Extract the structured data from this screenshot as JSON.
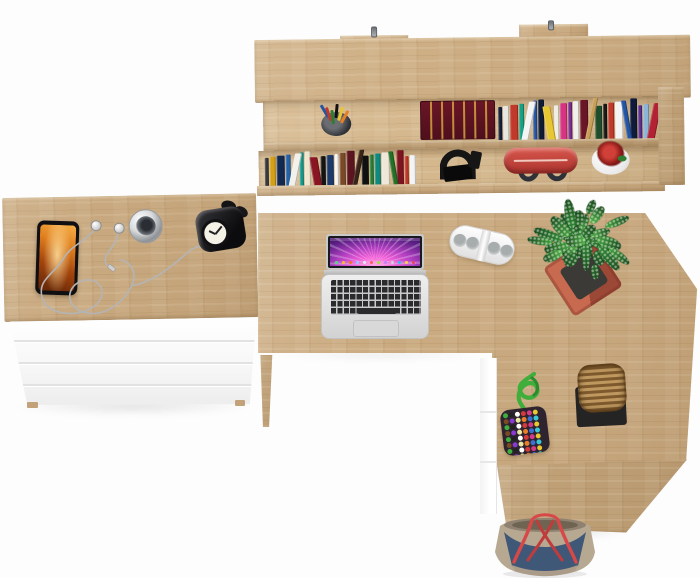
{
  "scene": {
    "description": "Top-down product photo of an oak office set: wall shelf full of books, chest of drawers with white fronts, and an L-shaped oak desk with a laptop and accessories",
    "background": "#fdfdfd"
  },
  "palette": {
    "oak": "#cbab81",
    "oak_light": "#d6b98f",
    "oak_dark": "#bfa076",
    "panel_white": "#fbfbfb",
    "pot_terracotta": "#b85a42",
    "plant_green": "#3c9a3f",
    "shelf_bag_red": "#c84540",
    "tote_denim": "#3f5878",
    "tote_canvas": "#b7a892",
    "strap_red": "#d84848",
    "rope_green": "#3fae3b",
    "red_book": "#5c1322"
  },
  "items": [
    "wall shelf with books",
    "mounting hooks",
    "pen cup",
    "red hardcover book",
    "black headphones",
    "red duffel bag",
    "white flower pot with red flowers",
    "chest of drawers",
    "smartphone",
    "white earphones",
    "chrome pocket watch",
    "black alarm clock",
    "l-shaped oak desk",
    "open laptop",
    "white power strip",
    "succulent in terracotta pot",
    "beaded pouch with green rope",
    "wicker basket on black tray",
    "canvas and denim tote bag"
  ],
  "shelf": {
    "hook_count": 2,
    "pen_colors": [
      "#2455a4",
      "#c0392b",
      "#2e7d32",
      "#111111",
      "#e8c832",
      "#e87f28"
    ],
    "books_top_row": [
      "#16213e",
      "#e8e6e0",
      "#c0392b",
      "#16a085",
      "#f4f4f4",
      "#2455a4",
      "#101c33",
      "#e8c832",
      "#f0ede6",
      "#d63384",
      "#7a2d8e",
      "#efefef",
      "#6a1626",
      "#c8a05a",
      "#1e4d2b",
      "#181818",
      "#c0392b",
      "#f4f4f4",
      "#2455a4",
      "#0f1b38",
      "#5b2d8e",
      "#8ab4d8",
      "#b22234",
      "#ece9e2",
      "#30426e",
      "#d0d0d0"
    ],
    "books_bottom_row": [
      "#3a3a3e",
      "#d4a017",
      "#122a52",
      "#2563a8",
      "#f2f0ea",
      "#159a8c",
      "#efe6d0",
      "#8a1522",
      "#141414",
      "#1a3a6b",
      "#f5f5f5",
      "#7a4a28",
      "#5c1520",
      "#3a2418",
      "#101010",
      "#2e7d32",
      "#0f8a80",
      "#efe8d8",
      "#256f28",
      "#7e1420",
      "#c0392b",
      "#f4f4f4"
    ]
  },
  "laptop": {
    "dock": {
      "colors": [
        "#8ecbff",
        "#ffd24a",
        "#ff5a5a",
        "#4ade80",
        "#c084fc",
        "#f97316",
        "#38bdf8",
        "#e2e8f0",
        "#f43f5e",
        "#a3e635",
        "#fbbf24",
        "#cbd5e1"
      ],
      "count": 12,
      "size": 3
    }
  },
  "power_strip": {
    "socket_count": 4
  },
  "plant": {
    "leaf_count": 34,
    "leaf_colors": [
      "#2f8a33",
      "#45a33f",
      "#57b84b",
      "#256f28"
    ]
  },
  "pouch": {
    "rope_color": "#3fae3b",
    "beads": {
      "colors": [
        "#d43a3a",
        "#3a6fd4",
        "#e8c832",
        "#3fae3b",
        "#8a3ad4",
        "#ffffff",
        "#e87f28",
        "#d43a8a",
        "#38c8d8",
        "#7a4a20",
        "#222222",
        "#e8e8a0"
      ],
      "count": 54,
      "size": 5
    }
  }
}
